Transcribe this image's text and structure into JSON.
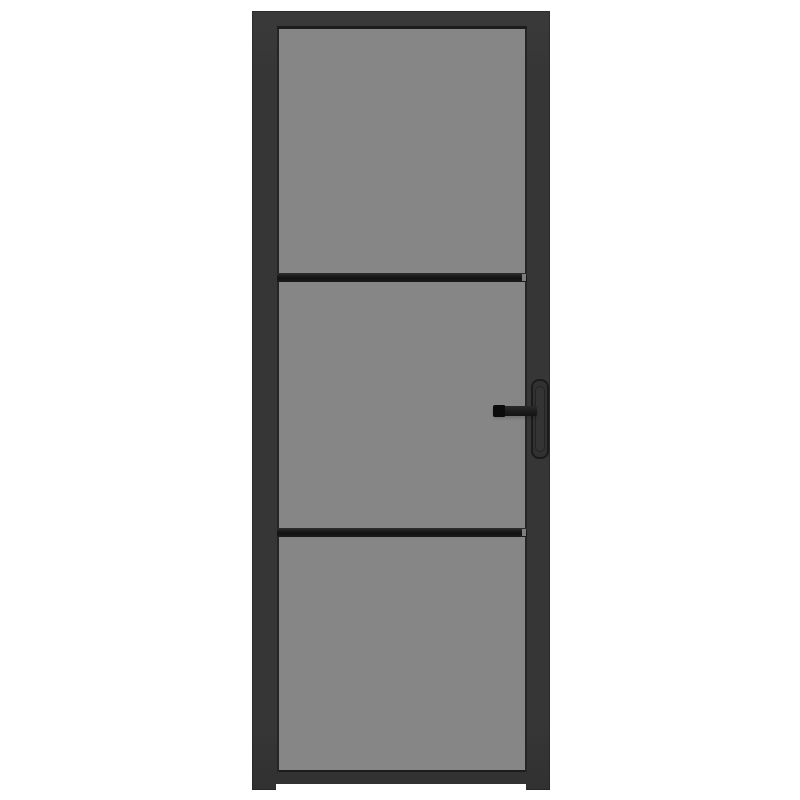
{
  "scene": {
    "type": "product-photo",
    "subject": "Black interior door with three smoked grey glass panels, two horizontal glazing bars and a black lever handle with vertical backplate on the right stile, centered on a white background"
  },
  "door": {
    "glass_panels": 3,
    "glazing_bars": 2,
    "handle_side": "right",
    "handle_parts": [
      "lever",
      "backplate"
    ],
    "feet": [
      "left",
      "right"
    ]
  },
  "colors": {
    "page_bg": "#ffffff",
    "frame": "#363636",
    "frame_edge_dark": "#1c1c1c",
    "glass": "#868686",
    "glass_edge_shadow": "#252525",
    "muntin": "#1d1d1d",
    "muntin_end_gap": "#7e7e7e",
    "lever": "#1f1f1f",
    "lever_cap": "#0b0b0b",
    "backplate": "#313131",
    "backplate_outline": "#1b1b1b"
  }
}
